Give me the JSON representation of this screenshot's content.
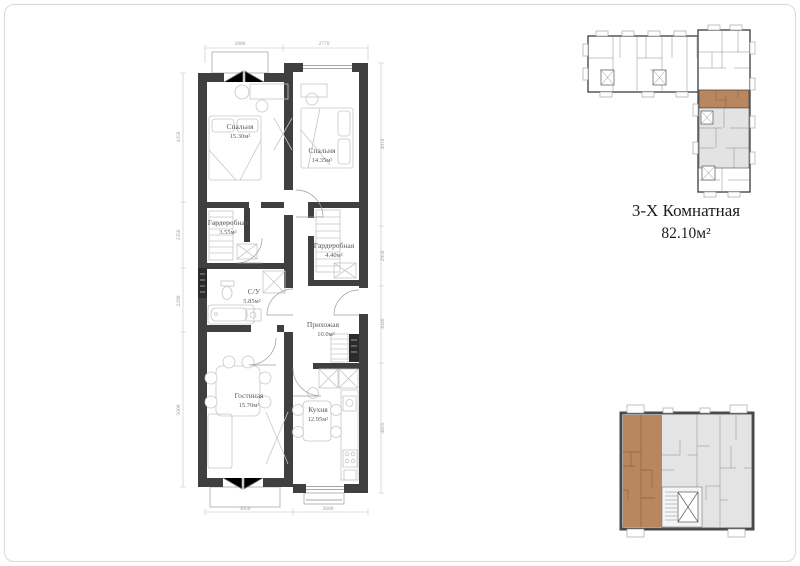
{
  "title": {
    "name": "3-Х Комнатная",
    "area": "82.10м²"
  },
  "floor_plan": {
    "rooms": [
      {
        "id": "bedroom-1",
        "name": "Спальня",
        "area": "15.30м²"
      },
      {
        "id": "bedroom-2",
        "name": "Спальня",
        "area": "14.35м²"
      },
      {
        "id": "wardrobe-1",
        "name": "Гардеробная",
        "area": "3.55м²"
      },
      {
        "id": "wardrobe-2",
        "name": "Гардеробная",
        "area": "4.40м²"
      },
      {
        "id": "bathroom",
        "name": "С/У",
        "area": "5.85м²"
      },
      {
        "id": "hallway",
        "name": "Прихожая",
        "area": "10.0м²"
      },
      {
        "id": "living",
        "name": "Гостиная",
        "area": "15.70м²"
      },
      {
        "id": "kitchen",
        "name": "Кухня",
        "area": "12.95м²"
      }
    ],
    "dimensions": {
      "top": [
        "2880",
        "2770"
      ],
      "bottom": [
        "3050",
        "2600"
      ],
      "left": [
        "4350",
        "2350",
        "2290",
        "5000"
      ],
      "right": [
        "4910",
        "2950",
        "3040",
        "4855"
      ]
    }
  },
  "colors": {
    "wall": "#3f3f3f",
    "highlight": "#b9875f",
    "other_unit_gray": "#e3e3e3",
    "dimension_text": "#9a9a9a",
    "furniture_line": "#c6c6c6"
  }
}
